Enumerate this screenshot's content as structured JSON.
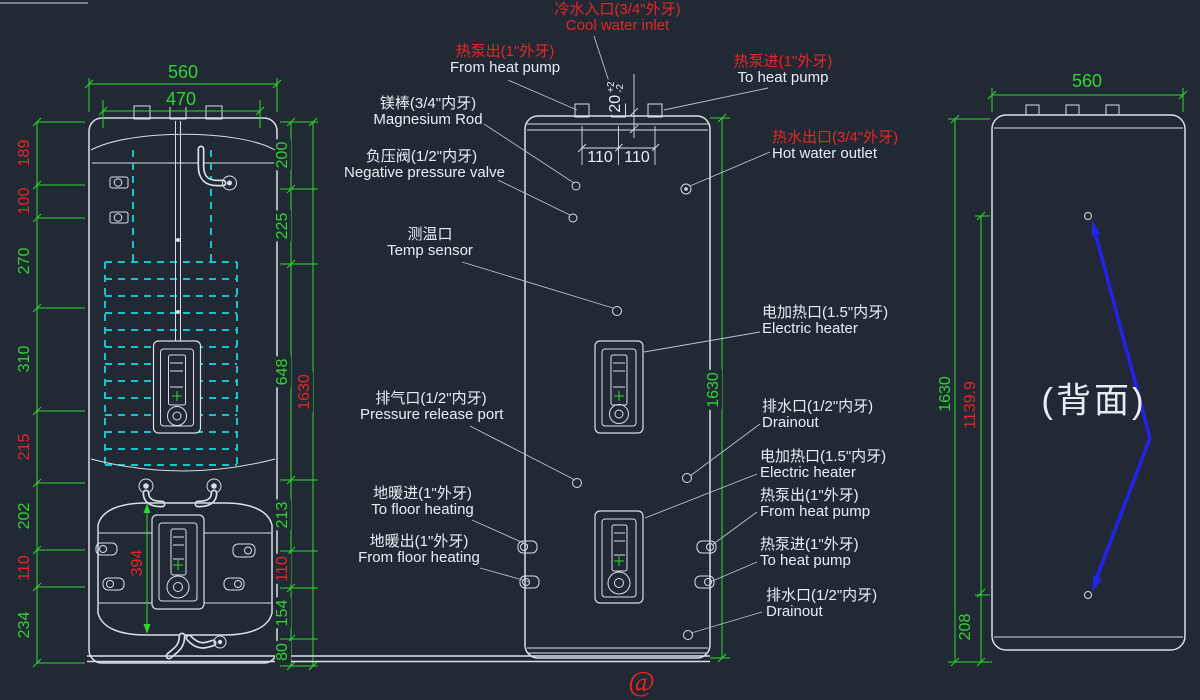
{
  "colors": {
    "bg": "#212a34",
    "line": "#d7dee6",
    "label": "#e8edf3",
    "leader": "#b9c3cc",
    "green": "#2ed52e",
    "red": "#e72525",
    "cyan": "#18c5cf",
    "blue": "#2222f5"
  },
  "left_view": {
    "dim_width_outer": {
      "value": "560",
      "color": "green"
    },
    "dim_width_inner": {
      "value": "470",
      "color": "green"
    },
    "left_dims": [
      {
        "value": "189",
        "color": "red"
      },
      {
        "value": "100",
        "color": "red"
      },
      {
        "value": "270",
        "color": "green"
      },
      {
        "value": "310",
        "color": "green"
      },
      {
        "value": "215",
        "color": "red"
      },
      {
        "value": "202",
        "color": "green"
      },
      {
        "value": "110",
        "color": "red"
      },
      {
        "value": "234",
        "color": "green"
      }
    ],
    "right_dims": [
      {
        "value": "200",
        "color": "green"
      },
      {
        "value": "225",
        "color": "green"
      },
      {
        "value": "648",
        "color": "green"
      },
      {
        "value": "213",
        "color": "green"
      },
      {
        "value": "110",
        "color": "red"
      },
      {
        "value": "154",
        "color": "green"
      },
      {
        "value": "80",
        "color": "green"
      }
    ],
    "dim_height_total": {
      "value": "1630",
      "color": "red"
    },
    "dim_flange_span": {
      "value": "394",
      "color": "red"
    }
  },
  "middle_view": {
    "dim_nozzle_height": {
      "nominal": "20",
      "tol_plus": "+2",
      "tol_minus": "-2",
      "color": "label"
    },
    "dim_spacing_left": {
      "value": "110",
      "color": "label"
    },
    "dim_spacing_right": {
      "value": "110",
      "color": "label"
    },
    "dim_height_total": {
      "value": "1630",
      "color": "green"
    },
    "labels": {
      "heat_pump_out_top": {
        "cn": "热泵出(1\"外牙)",
        "en": "From heat pump"
      },
      "cool_water_inlet": {
        "cn": "冷水入口(3/4\"外牙)",
        "en": "Cool water inlet"
      },
      "heat_pump_in_top": {
        "cn": "热泵进(1\"外牙)",
        "en": "To heat pump"
      },
      "magnesium_rod": {
        "cn": "镁棒(3/4\"内牙)",
        "en": "Magnesium Rod"
      },
      "negative_pressure_valve": {
        "cn": "负压阀(1/2\"内牙)",
        "en": "Negative pressure valve"
      },
      "temp_sensor": {
        "cn": "测温口",
        "en": "Temp sensor"
      },
      "hot_water_outlet": {
        "cn": "热水出口(3/4\"外牙)",
        "en": "Hot water outlet"
      },
      "electric_heater_1": {
        "cn": "电加热口(1.5\"内牙)",
        "en": "Electric heater"
      },
      "pressure_release_port": {
        "cn": "排气口(1/2\"内牙)",
        "en": "Pressure release port"
      },
      "drainout_1": {
        "cn": "排水口(1/2\"内牙)",
        "en": "Drainout"
      },
      "electric_heater_2": {
        "cn": "电加热口(1.5\"内牙)",
        "en": "Electric heater"
      },
      "heat_pump_out_side": {
        "cn": "热泵出(1\"外牙)",
        "en": "From heat pump"
      },
      "heat_pump_in_side": {
        "cn": "热泵进(1\"外牙)",
        "en": "To heat pump"
      },
      "floor_heating_in": {
        "cn": "地暖进(1\"外牙)",
        "en": "To floor heating"
      },
      "floor_heating_out": {
        "cn": "地暖出(1\"外牙)",
        "en": "From floor heating"
      },
      "drainout_2": {
        "cn": "排水口(1/2\"内牙)",
        "en": "Drainout"
      }
    }
  },
  "right_view": {
    "dim_width": {
      "value": "560",
      "color": "green"
    },
    "dim_height_total": {
      "value": "1630",
      "color": "green"
    },
    "dim_port_span": {
      "value": "1139.9",
      "color": "red"
    },
    "dim_bottom": {
      "value": "208",
      "color": "green"
    },
    "caption": "(背面)"
  },
  "watermark": "@"
}
